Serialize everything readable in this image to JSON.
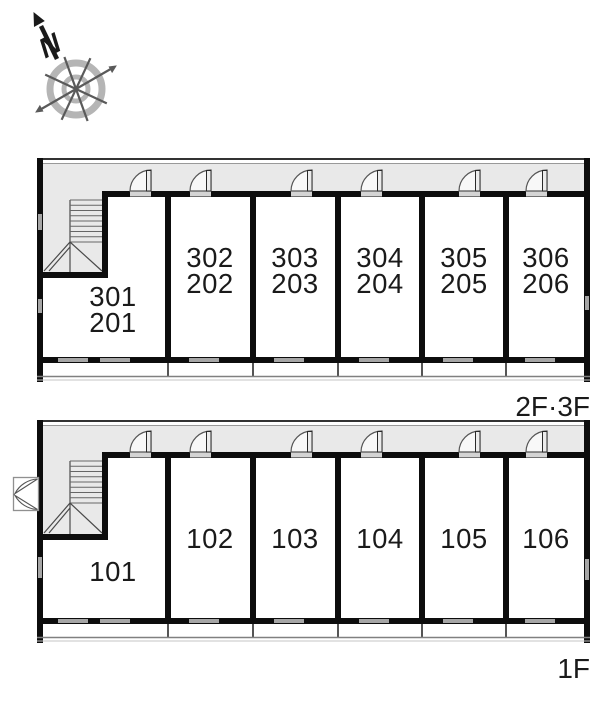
{
  "page": {
    "type": "apartment-building-floor-plan"
  },
  "compass": {
    "north_label": "N",
    "icon": "compass-rose-icon"
  },
  "colors": {
    "wall": "#0d0d0d",
    "corridor_fill": "#e9e9e9",
    "window_gray": "#a6a6a6",
    "text": "#1a1a1a",
    "compass_ring": "#b5b5b5"
  },
  "floors": [
    {
      "label": "2F·3F",
      "rooms": [
        {
          "line1": "301",
          "line2": "201"
        },
        {
          "line1": "302",
          "line2": "202"
        },
        {
          "line1": "303",
          "line2": "203"
        },
        {
          "line1": "304",
          "line2": "204"
        },
        {
          "line1": "305",
          "line2": "205"
        },
        {
          "line1": "306",
          "line2": "206"
        }
      ]
    },
    {
      "label": "1F",
      "rooms": [
        {
          "line1": "101"
        },
        {
          "line1": "102"
        },
        {
          "line1": "103"
        },
        {
          "line1": "104"
        },
        {
          "line1": "105"
        },
        {
          "line1": "106"
        }
      ]
    }
  ]
}
